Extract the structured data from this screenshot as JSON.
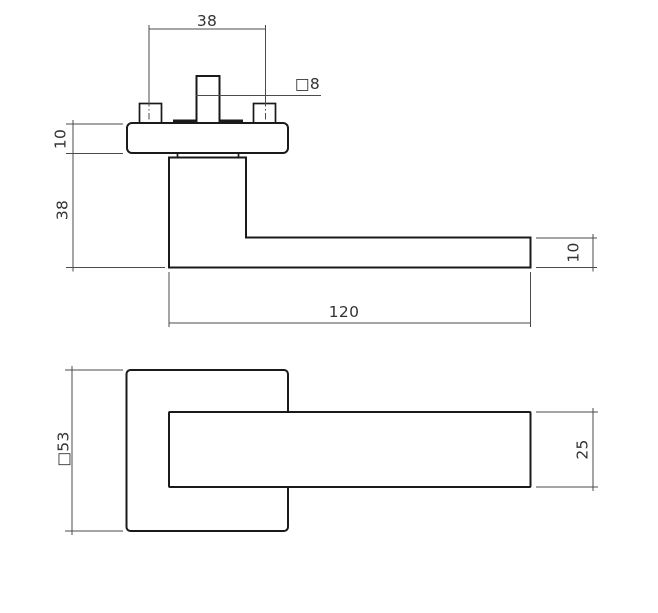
{
  "drawing": {
    "description": "door-handle-technical-drawing",
    "colors": {
      "object_line": "#1a1a1a",
      "dim_line": "#4b4b4b",
      "text_color": "#333333",
      "background": "#ffffff"
    },
    "front_view": {
      "dims": {
        "screw_spacing": "38",
        "spindle_size": "□8",
        "rosette_thickness": "10",
        "handle_height": "38",
        "handle_length": "120",
        "grip_thickness": "10"
      }
    },
    "plan_view": {
      "dims": {
        "rosette_size": "□53",
        "grip_width": "25"
      }
    }
  }
}
